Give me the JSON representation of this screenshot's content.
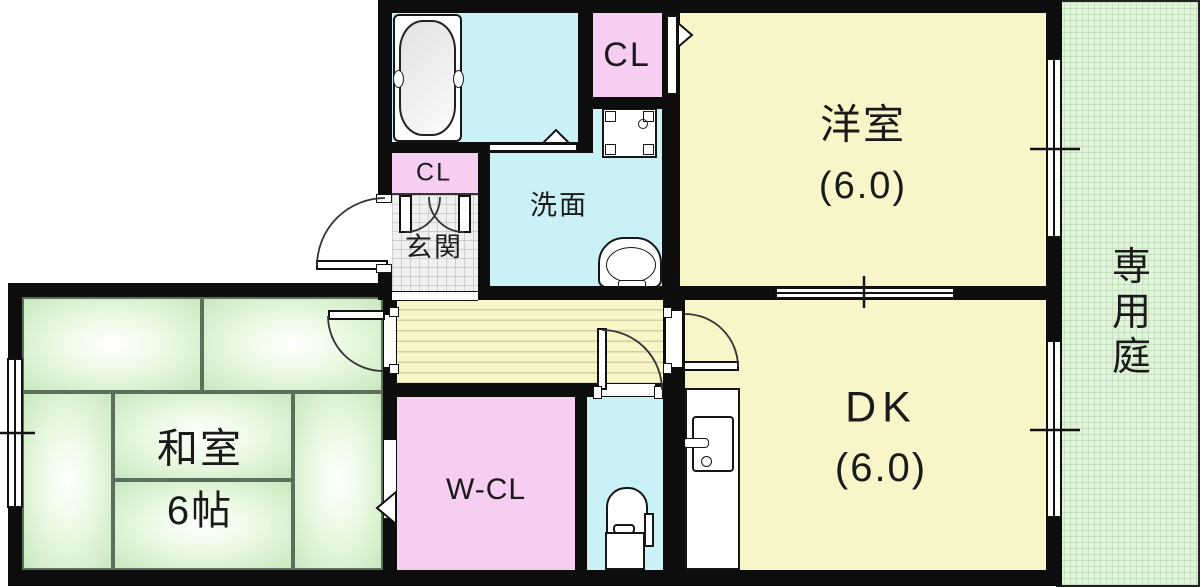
{
  "floorplan": {
    "rooms": {
      "western": {
        "label": "洋室",
        "size": "(6.0)"
      },
      "dk": {
        "label": "DK",
        "size": "(6.0)"
      },
      "japanese": {
        "label": "和室",
        "size": "6帖"
      },
      "washroom": {
        "label": "洗面"
      },
      "entrance": {
        "label": "玄関"
      },
      "upper_closet": {
        "label": "CL"
      },
      "entrance_closet": {
        "label": "CL"
      },
      "walk_in_closet": {
        "label": "W-CL"
      },
      "garden": {
        "label": "専用庭"
      }
    },
    "colors": {
      "wall": "#0d0d0d",
      "room_yellow": "#f8f5c9",
      "room_cyan": "#c9f1f6",
      "room_pink": "#f6cef2",
      "tatami_green": "#d9f2d0",
      "garden_green": "#e3f2dc",
      "entrance_tile": "#f0f0f0"
    }
  }
}
